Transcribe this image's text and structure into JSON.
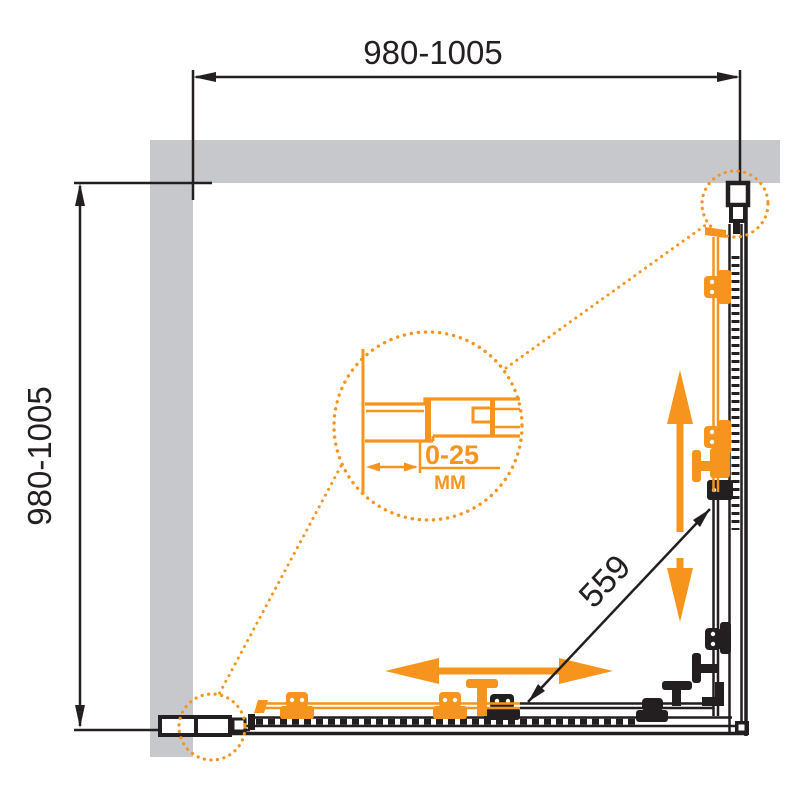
{
  "drawing": {
    "type": "shower-enclosure-plan-view",
    "dimensions": {
      "top": {
        "label": "980-1005"
      },
      "left": {
        "label": "980-1005"
      },
      "diagonal": {
        "label": "559"
      }
    },
    "detail": {
      "range": "0-25",
      "unit": "ММ"
    },
    "colors": {
      "accent_orange": "#F7941D",
      "wall_gray": "#C7C8CC",
      "line_black": "#231F20",
      "background": "#FFFFFF"
    },
    "icons": {
      "vertical_slide_arrow": "double-arrow-vertical",
      "horizontal_slide_arrow": "double-arrow-horizontal",
      "detail_callout": "dotted-magnifier-circle"
    }
  }
}
